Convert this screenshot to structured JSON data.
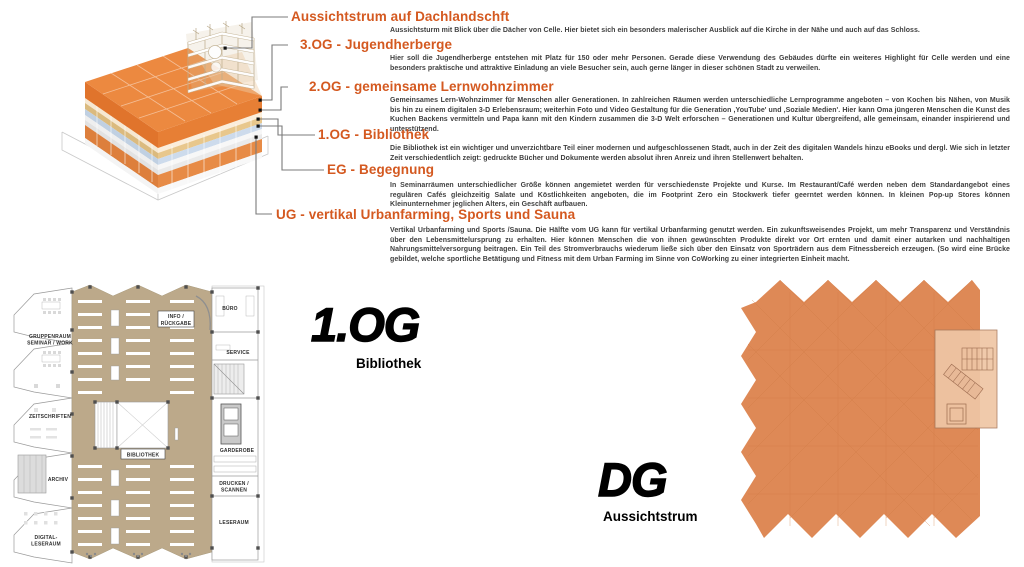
{
  "annotations": {
    "sections": [
      {
        "heading": "Aussichtstrum auf Dachlandschft",
        "body": "Aussichtsturm mit Blick über die Dächer von Celle.  Hier bietet sich ein besonders malerischer Ausblick auf die Kirche in der Nähe und auch auf das Schloss."
      },
      {
        "heading": "3.OG - Jugendherberge",
        "body": "Hier soll die Jugendherberge entstehen mit Platz für 150 oder mehr Personen. Gerade diese Verwendung des Gebäudes dürfte ein weiteres Highlight für Celle werden und eine besonders praktische und attraktive Einladung an viele Besucher sein, auch gerne länger in dieser schönen Stadt zu verweilen."
      },
      {
        "heading": "2.OG - gemeinsame Lernwohnzimmer",
        "body": "Gemeinsames Lern-Wohnzimmer für Menschen aller Generationen. In zahlreichen Räumen werden unterschiedliche Lernprogramme angeboten – von Kochen bis Nähen, von Musik bis hin zu einem digitalen 3-D Erlebensraum; weiterhin Foto und Video Gestaltung für die Generation ,YouTube' und ,Soziale Medien'. Hier kann Oma jüngeren Menschen die Kunst des Kuchen Backens vermitteln und Papa kann mit den Kindern zusammen die 3-D Welt erforschen – Generationen und Kultur übergreifend, alle gemeinsam, einander inspirierend und unterstützend."
      },
      {
        "heading": "1.OG - Bibliothek",
        "body": "Die Bibliothek ist ein wichtiger und unverzichtbare Teil einer modernen und aufgeschlossenen Stadt, auch in der Zeit des digitalen Wandels hinzu eBooks und dergl. Wie sich in letzter Zeit verschiedentlich zeigt: gedruckte Bücher und Dokumente werden absolut ihren Anreiz und ihren Stellenwert behalten."
      },
      {
        "heading": "EG - Begegnung",
        "body": "In Seminarräumen unterschiedlicher Größe können angemietet werden für verschiedenste Projekte und Kurse. Im Restaurant/Café werden neben dem Standardangebot eines regulären Cafés gleichzeitig Salate und Köstlichkeiten angeboten, die im Footprint Zero ein Stockwerk tiefer geerntet werden können. In kleinen Pop-up Stores können Kleinunternehmer jeglichen Alters, ein Geschäft aufbauen."
      },
      {
        "heading": "UG - vertikal Urbanfarming, Sports und Sauna",
        "body": "Vertikal Urbanfarming und Sports /Sauna. Die Hälfte vom UG kann für vertikal Urbanfarming genutzt werden. Ein zukunftsweisendes Projekt, um mehr Transparenz und Verständnis über den Lebensmittelursprung zu erhalten. Hier können Menschen die von ihnen gewünschten Produkte direkt vor Ort ernten und damit einer autarken und nachhaltigen Nahrungsmittelversorgung  beitragen. Ein Teil des Stromverbrauchs wiederum ließe sich über den Einsatz von Sporträdern aus dem Fitnessbereich erzeugen. (So wird eine Brücke gebildet, welche sportliche Betätigung und Fitness mit dem Urban Farming im Sinne von CoWorking zu einer integrierten Einheit macht."
      }
    ]
  },
  "floor_plan": {
    "title": "1.OG",
    "subtitle": "Bibliothek",
    "rooms": {
      "gruppenraum_line1": "GRUPPENRAUM",
      "gruppenraum_line2": "SEMINAR / WORK",
      "zeitschriften": "ZEITSCHRIFTEN",
      "archiv": "ARCHIV",
      "digital_line1": "DIGITAL-",
      "digital_line2": "LESERAUM",
      "info_line1": "INFO /",
      "info_line2": "RÜCKGABE",
      "bibliothek": "BIBLIOTHEK",
      "buero": "BÜRO",
      "service": "SERVICE",
      "garderobe": "GARDEROBE",
      "drucken_line1": "DRUCKEN /",
      "drucken_line2": "SCANNEN",
      "leseraum": "LESERAUM"
    }
  },
  "roof_plan": {
    "title": "DG",
    "subtitle": "Aussichtstrum"
  },
  "colors": {
    "heading_orange": "#d45920",
    "body_text": "#3f3f3f",
    "model_roof_orange": "#ec8940",
    "roof_plan_orange": "#de8956",
    "plan_tan": "#bca98a",
    "tower_overlay_peach": "#efc6a5",
    "layer_gold": "#e2c186",
    "layer_blue": "#c6d6e8",
    "leader_line_gray": "#7b7b7b"
  }
}
